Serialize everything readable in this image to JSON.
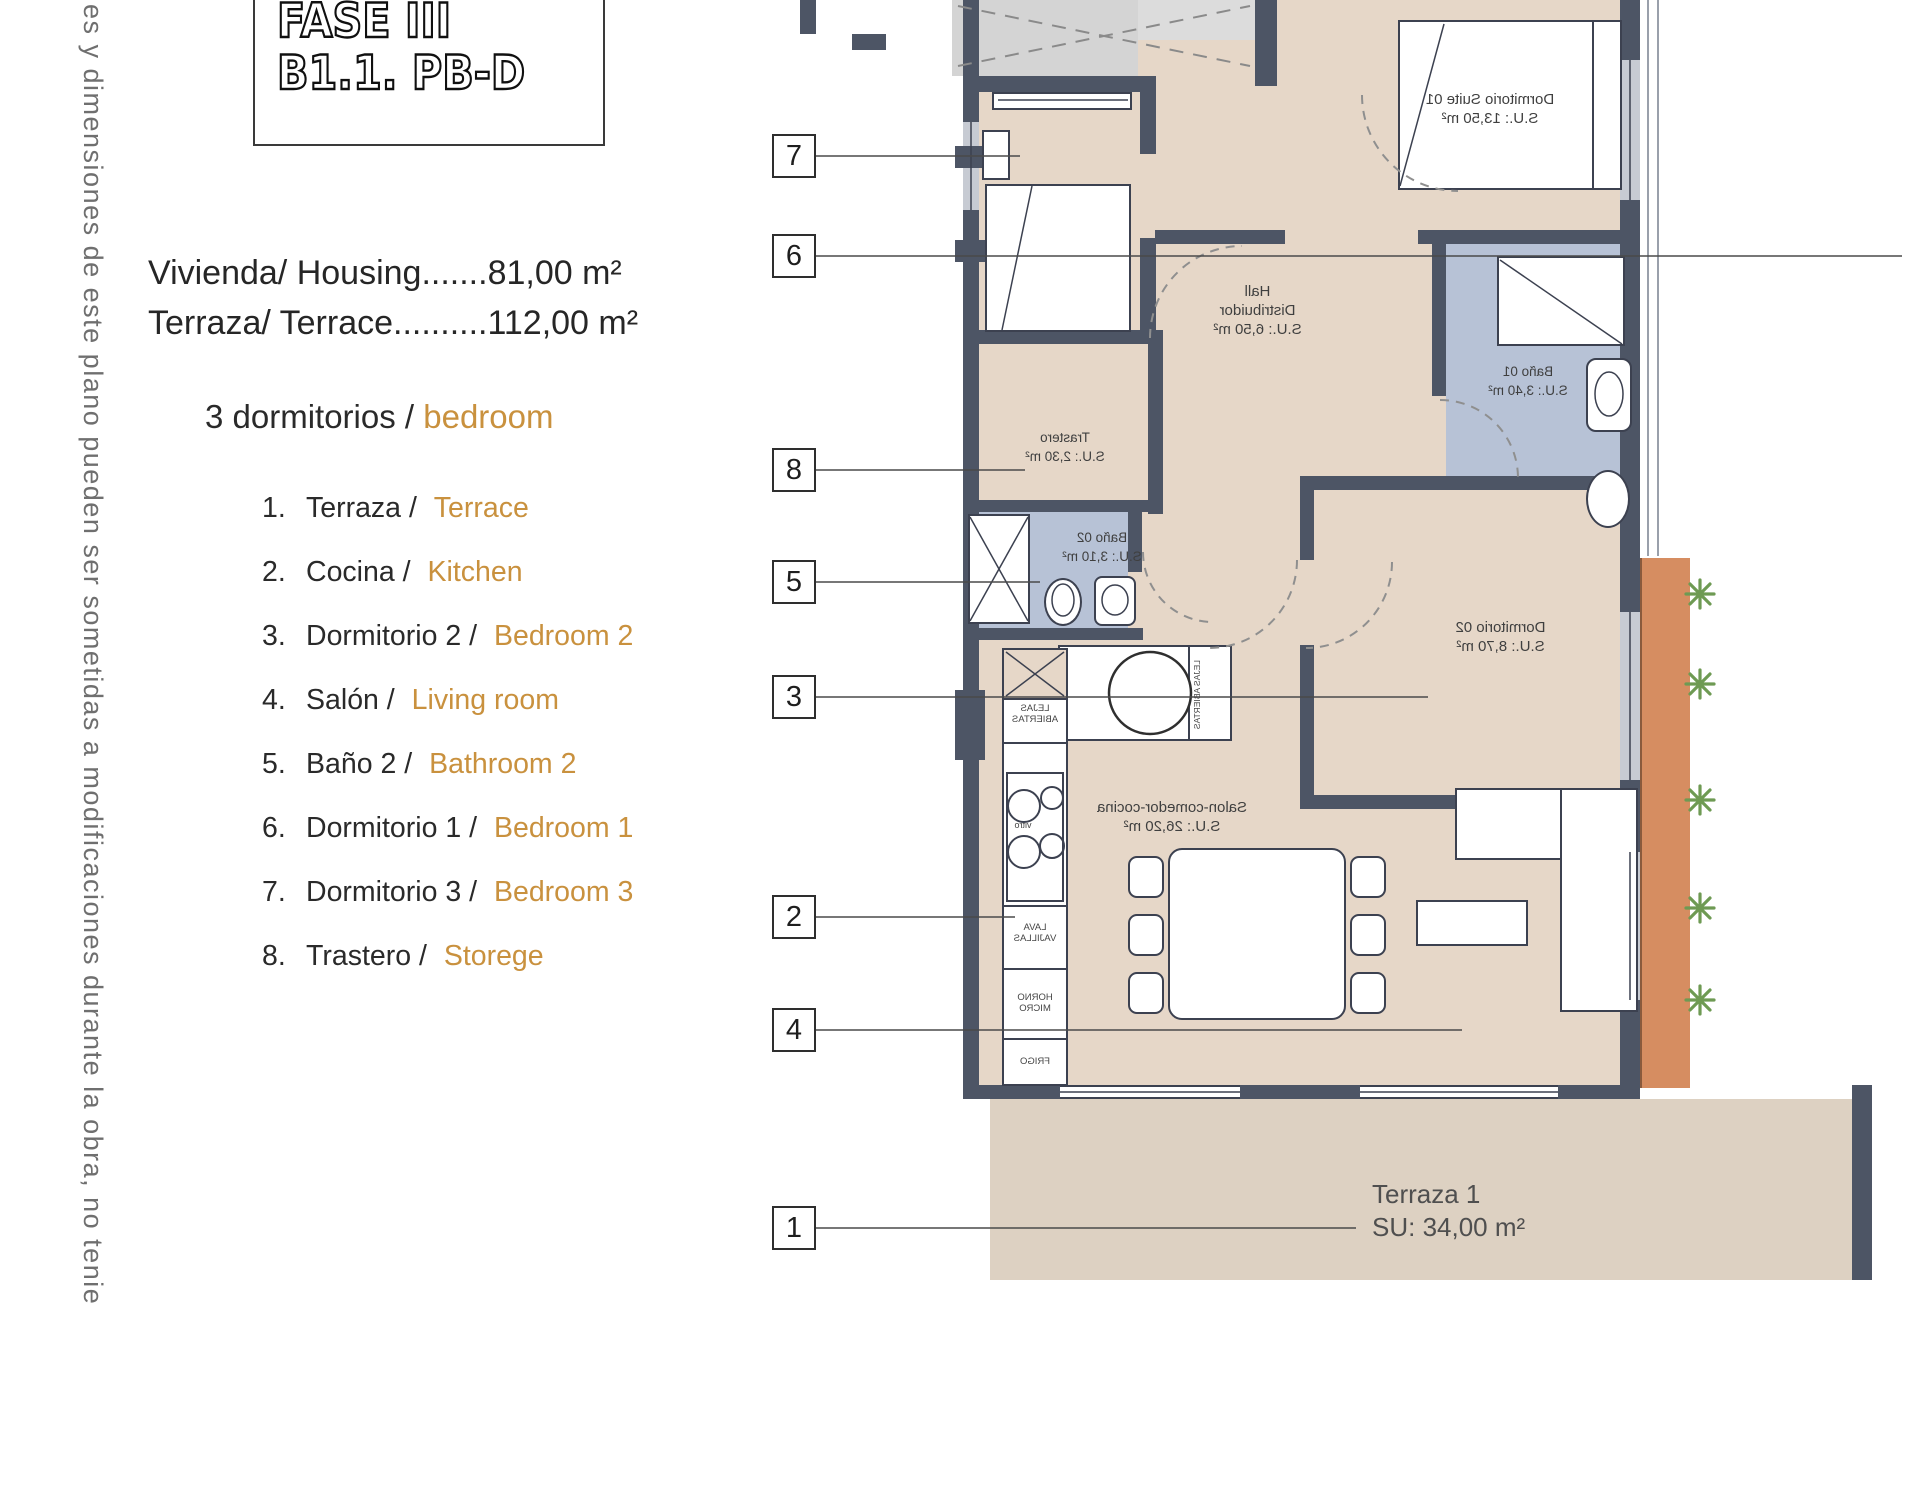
{
  "side_note": "es y dimensiones de este plano pueden ser sometidas a modificaciones durante la obra, no tenie",
  "title_block": {
    "line1": "FASE III",
    "line2": "B1.1. PB-D"
  },
  "summary": {
    "housing": "Vivienda/ Housing.......81,00 m²",
    "terrace": "Terraza/ Terrace..........112,00 m²"
  },
  "legend": {
    "heading_prefix": "3 dormitorios / ",
    "heading_accent": "bedroom",
    "items": [
      {
        "num": "1.",
        "es": "Terraza / ",
        "en": "Terrace"
      },
      {
        "num": "2.",
        "es": "Cocina / ",
        "en": "Kitchen"
      },
      {
        "num": "3.",
        "es": "Dormitorio 2 / ",
        "en": "Bedroom 2"
      },
      {
        "num": "4.",
        "es": "Salón / ",
        "en": "Living room"
      },
      {
        "num": "5.",
        "es": "Baño 2 / ",
        "en": "Bathroom 2"
      },
      {
        "num": "6.",
        "es": "Dormitorio 1 / ",
        "en": "Bedroom 1"
      },
      {
        "num": "7.",
        "es": "Dormitorio 3 / ",
        "en": "Bedroom 3"
      },
      {
        "num": "8.",
        "es": "Trastero / ",
        "en": "Storege"
      }
    ]
  },
  "callouts": {
    "c1": "1",
    "c2": "2",
    "c3": "3",
    "c4": "4",
    "c5": "5",
    "c6": "6",
    "c7": "7",
    "c8": "8"
  },
  "rooms": {
    "suite01": {
      "name": "Dormitorio Suite 01",
      "area": "S.U.: 13,50 m²"
    },
    "hall": {
      "name": "Hall",
      "name2": "Distribuidor",
      "area": "S.U.: 6,50 m²"
    },
    "bano01": {
      "name": "Baño 01",
      "area": "S.U.: 3,40 m²"
    },
    "trastero": {
      "name": "Trastero",
      "area": "S.U.: 2,30 m²"
    },
    "bano02": {
      "name": "Baño 02",
      "area": "S.U.: 3,10 m²"
    },
    "dorm02": {
      "name": "Dormitorio 02",
      "area": "S.U.: 8,70 m²"
    },
    "salon": {
      "name": "Salon-comedor-cocina",
      "area": "S.U.: 26,20 m²"
    },
    "terraza1": {
      "name": "Terraza 1",
      "area": "SU: 34,00 m²"
    }
  },
  "kitchen": {
    "shelves_l1": "LEJAS",
    "shelves_l2": "ABIERTAS",
    "hob": "vitro",
    "dishwasher_l1": "LAVA",
    "dishwasher_l2": "VAJILLAS",
    "oven_l1": "HORNO",
    "oven_l2": "MICRO",
    "fridge": "FRIGO",
    "laundry_l1": "ACS",
    "laundry_l2": "LAV.",
    "side_shelves": "LEJAS ABIERTAS"
  },
  "colors": {
    "accent_orange": "#c9913e",
    "terrace_strip": "#d68d61",
    "floor": "#e6d7c8",
    "wall": "#4d5565",
    "bath_blue": "#b7c2d6",
    "plant_green": "#6e9a53"
  }
}
